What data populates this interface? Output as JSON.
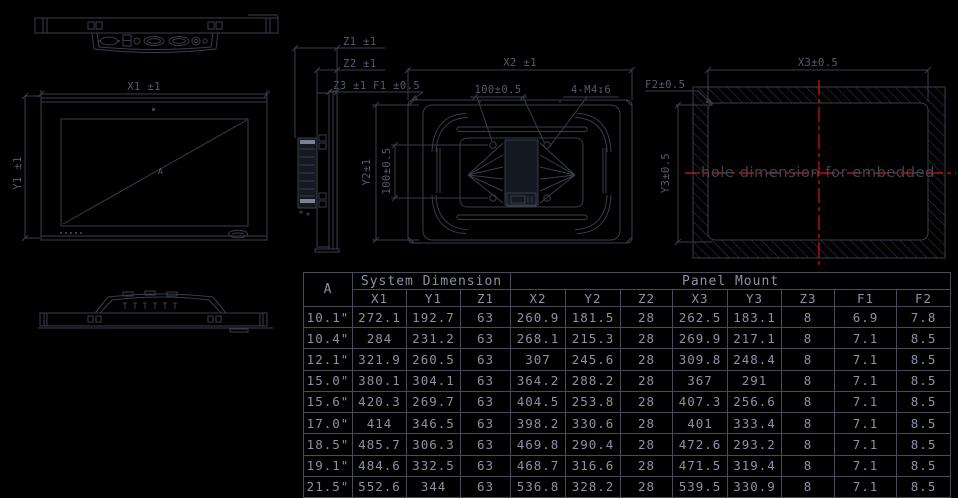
{
  "views": {
    "front_view": {
      "dim_width": "X1 ±1",
      "dim_height": "Y1 ±1",
      "diagonal_label": "A"
    },
    "side_view": {
      "dim_z1": "Z1 ±1",
      "dim_z2": "Z2 ±1",
      "dim_z3": "Z3 ±1",
      "dim_f1": "F1 ±0.5"
    },
    "rear_view": {
      "dim_x2": "X2 ±1",
      "dim_vesa_horizontal": "100±0.5",
      "dim_thread": "4-M4↧6",
      "dim_y2": "Y2±1",
      "dim_vesa_vertical": "100±0.5"
    },
    "cutout_view": {
      "dim_x3": "X3±0.5",
      "dim_f2": "F2±0.5",
      "dim_y3": "Y3±0.5",
      "note": "hole dimension for embedded"
    }
  },
  "table": {
    "corner_header": "A",
    "groups": [
      {
        "label": "System Dimension",
        "span": 3
      },
      {
        "label": "Panel Mount",
        "span": 8
      }
    ],
    "columns": [
      "X1",
      "Y1",
      "Z1",
      "X2",
      "Y2",
      "Z2",
      "X3",
      "Y3",
      "Z3",
      "F1",
      "F2"
    ],
    "rows": [
      {
        "size": "10.1\"",
        "values": [
          "272.1",
          "192.7",
          "63",
          "260.9",
          "181.5",
          "28",
          "262.5",
          "183.1",
          "8",
          "6.9",
          "7.8"
        ]
      },
      {
        "size": "10.4\"",
        "values": [
          "284",
          "231.2",
          "63",
          "268.1",
          "215.3",
          "28",
          "269.9",
          "217.1",
          "8",
          "7.1",
          "8.5"
        ]
      },
      {
        "size": "12.1\"",
        "values": [
          "321.9",
          "260.5",
          "63",
          "307",
          "245.6",
          "28",
          "309.8",
          "248.4",
          "8",
          "7.1",
          "8.5"
        ]
      },
      {
        "size": "15.0\"",
        "values": [
          "380.1",
          "304.1",
          "63",
          "364.2",
          "288.2",
          "28",
          "367",
          "291",
          "8",
          "7.1",
          "8.5"
        ]
      },
      {
        "size": "15.6\"",
        "values": [
          "420.3",
          "269.7",
          "63",
          "404.5",
          "253.8",
          "28",
          "407.3",
          "256.6",
          "8",
          "7.1",
          "8.5"
        ]
      },
      {
        "size": "17.0\"",
        "values": [
          "414",
          "346.5",
          "63",
          "398.2",
          "330.6",
          "28",
          "401",
          "333.4",
          "8",
          "7.1",
          "8.5"
        ]
      },
      {
        "size": "18.5\"",
        "values": [
          "485.7",
          "306.3",
          "63",
          "469.8",
          "290.4",
          "28",
          "472.6",
          "293.2",
          "8",
          "7.1",
          "8.5"
        ]
      },
      {
        "size": "19.1\"",
        "values": [
          "484.6",
          "332.5",
          "63",
          "468.7",
          "316.6",
          "28",
          "471.5",
          "319.4",
          "8",
          "7.1",
          "8.5"
        ]
      },
      {
        "size": "21.5\"",
        "values": [
          "552.6",
          "344",
          "63",
          "536.8",
          "328.2",
          "28",
          "539.5",
          "330.9",
          "8",
          "7.1",
          "8.5"
        ]
      }
    ]
  },
  "colors": {
    "background": "#000000",
    "line_color": "#373e4b",
    "dim_text_color": "#535b6b",
    "note_text_color": "#3e4554",
    "table_text_color": "#8a92a3",
    "table_border_color": "#454c5b",
    "centerline_red": "#e01212",
    "dark_fill": "#141821"
  }
}
